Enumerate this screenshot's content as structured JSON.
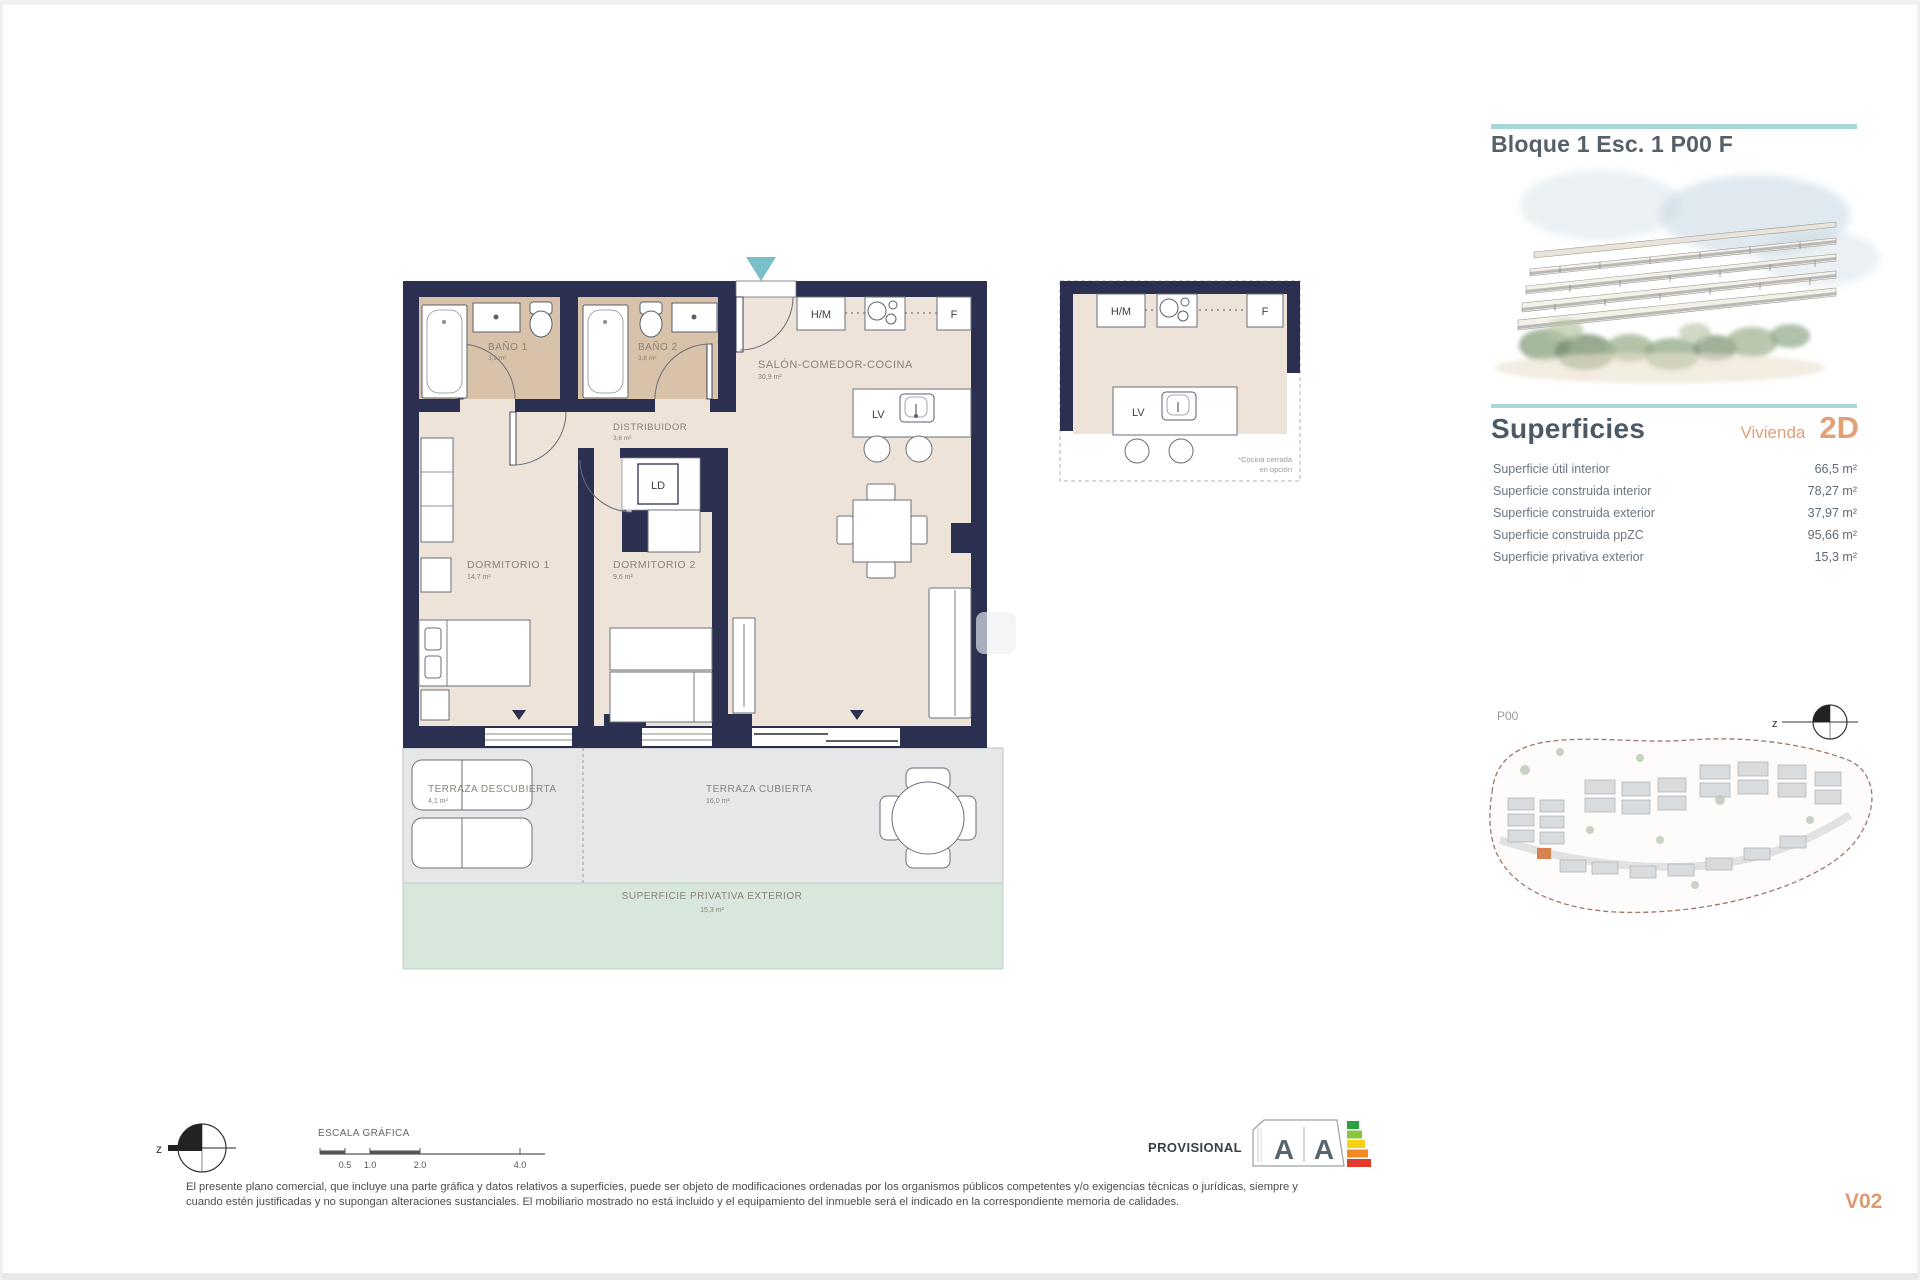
{
  "header": {
    "title": "Bloque 1 Esc. 1 P00 F"
  },
  "superficies": {
    "heading": "Superficies",
    "vivienda_label": "Vivienda",
    "vivienda_type": "2D",
    "rows": [
      {
        "label": "Superficie útil interior",
        "value": "66,5 m²"
      },
      {
        "label": "Superficie construida interior",
        "value": "78,27 m²"
      },
      {
        "label": "Superficie construida exterior",
        "value": "37,97 m²"
      },
      {
        "label": "Superficie construida ppZC",
        "value": "95,66 m²"
      },
      {
        "label": "Superficie privativa exterior",
        "value": "15,3 m²"
      }
    ]
  },
  "floorplan": {
    "rooms": [
      {
        "name": "BAÑO 1",
        "area": "3,9 m²"
      },
      {
        "name": "BAÑO 2",
        "area": "3,8 m²"
      },
      {
        "name": "SALÓN-COMEDOR-COCINA",
        "area": "30,9 m²"
      },
      {
        "name": "DISTRIBUIDOR",
        "area": "3,6 m²"
      },
      {
        "name": "DORMITORIO 1",
        "area": "14,7 m²"
      },
      {
        "name": "DORMITORIO 2",
        "area": "9,6 m²"
      },
      {
        "name": "TERRAZA DESCUBIERTA",
        "area": "4,1 m²"
      },
      {
        "name": "TERRAZA CUBIERTA",
        "area": "16,0 m²"
      },
      {
        "name": "SUPERFICIE PRIVATIVA EXTERIOR",
        "area": "15,3 m²"
      }
    ],
    "labels": {
      "hm": "H/M",
      "f": "F",
      "lv": "LV",
      "ld": "LD"
    },
    "kitchen_note_line1": "*Cocina cerrada",
    "kitchen_note_line2": "en opción"
  },
  "siteplan": {
    "floor_label": "P00",
    "north_label": "z"
  },
  "footer": {
    "scale_title": "ESCALA GRÁFICA",
    "scale_ticks": [
      "0.5",
      "1.0",
      "2.0",
      "4.0"
    ],
    "north_label": "z",
    "disclaimer_line1": "El presente plano comercial, que incluye una parte gráfica y datos relativos a superficies, puede ser objeto de modificaciones ordenadas por los organismos públicos competentes y/o exigencias técnicas o jurídicas, siempre y",
    "disclaimer_line2": "cuando estén justificadas y no supongan alteraciones sustanciales. El mobiliario mostrado no está incluido y el equipamiento del inmueble será el indicado en la correspondiente memoria de calidades.",
    "provisional": "PROVISIONAL",
    "energy_letters": [
      "A",
      "A"
    ],
    "version": "V02"
  },
  "colors": {
    "wall_navy": "#2b3050",
    "floor_beige": "#ede3d8",
    "bath_tan": "#d8c2a9",
    "terrace_gray": "#e6e7e9",
    "private_green": "#d8e7db",
    "accent_teal": "#a9d6d6",
    "accent_orange": "#e2a077",
    "entry_teal": "#79bfc7"
  }
}
